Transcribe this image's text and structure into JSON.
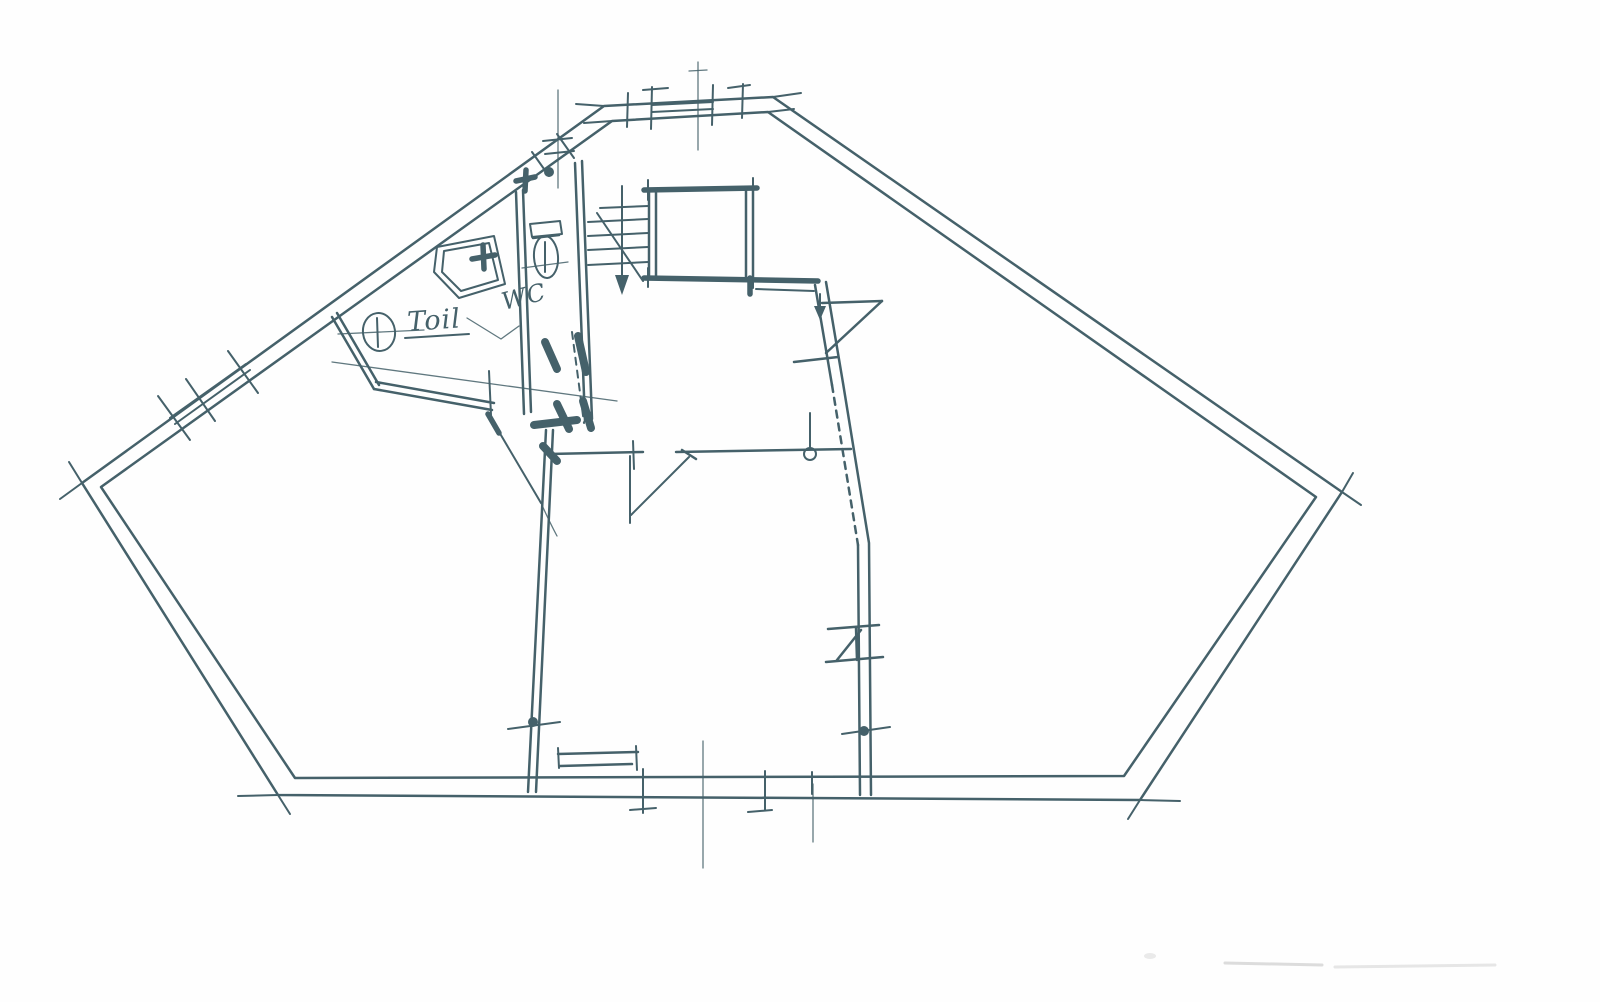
{
  "plan": {
    "labels": {
      "toilet_room": "Toil",
      "wc_room": "WC"
    },
    "colors": {
      "ink": "#45616a",
      "ink_light": "#7e979b",
      "paper": "#fefefe",
      "smudge": "#dcdcdc"
    }
  }
}
